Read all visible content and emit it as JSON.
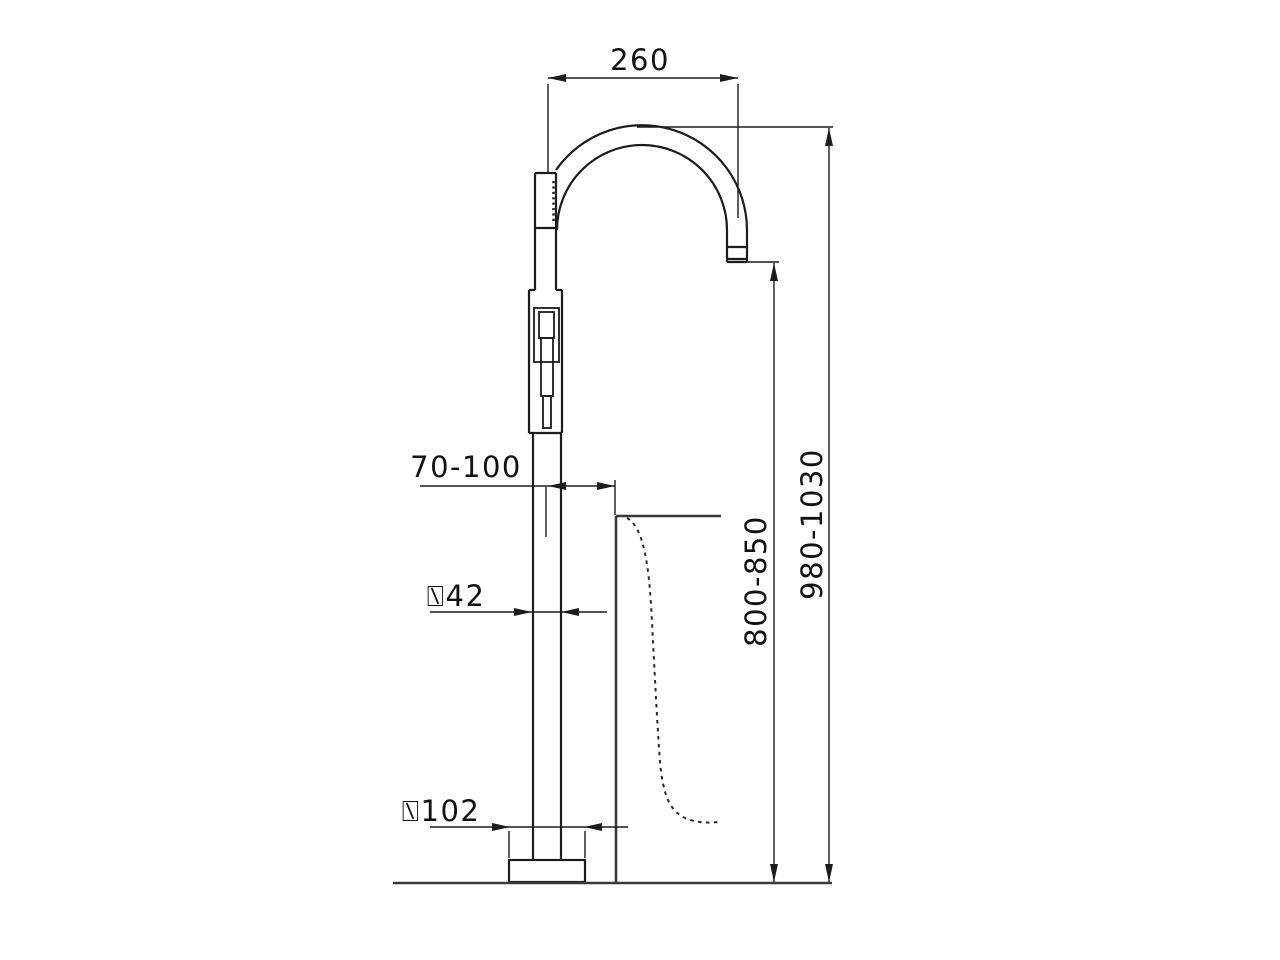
{
  "drawing": {
    "description": "technical dimension drawing of a freestanding floor-mounted bathtub faucet with curved gooseneck spout, hand shower and bathtub section profile",
    "labels": {
      "spout_reach": "260",
      "total_height": "980-1030",
      "spout_outlet_height": "800-850",
      "tub_edge_offset": "70-100",
      "body_diameter": "⍂42",
      "base_diameter": "⍂102"
    },
    "colors": {
      "line": "#1c1c1c",
      "heavy_line": "#3a3a3a",
      "background": "#ffffff"
    }
  }
}
